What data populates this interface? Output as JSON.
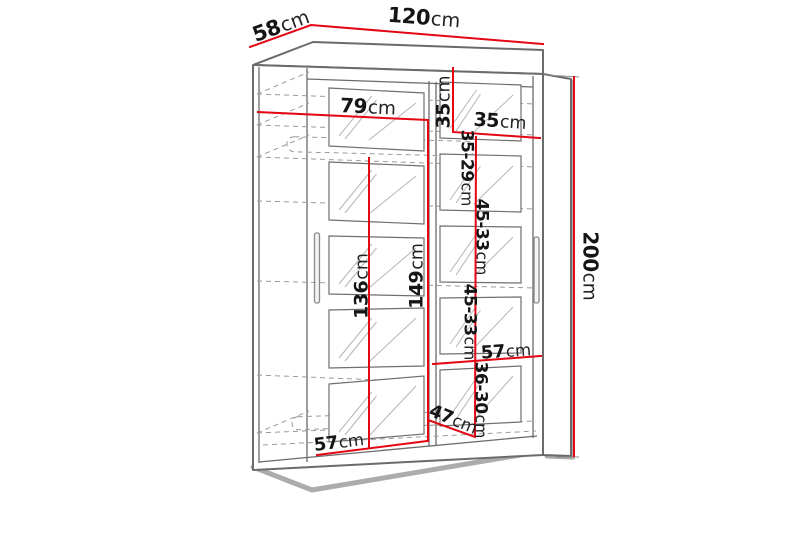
{
  "figure": {
    "type": "furniture-dimension-diagram",
    "subject": "sliding-door wardrobe with mirror panels",
    "unit": "cm"
  },
  "colors": {
    "dimension_line": "#e30613",
    "structure_line": "#6b6b6b",
    "dashed_line": "#9a9a9a",
    "text": "#151515",
    "background": "#ffffff"
  },
  "labels": {
    "depth_top": {
      "value": "58",
      "unit": "cm"
    },
    "width_top": {
      "value": "120",
      "unit": "cm"
    },
    "height_right": {
      "value": "200",
      "unit": "cm"
    },
    "hang_section_width": {
      "value": "79",
      "unit": "cm"
    },
    "top_shelf_height": {
      "value": "35",
      "unit": "cm"
    },
    "top_right_width": {
      "value": "35",
      "unit": "cm"
    },
    "shelf_gap_1": {
      "value": "35-29",
      "unit": "cm"
    },
    "shelf_gap_2": {
      "value": "45-33",
      "unit": "cm"
    },
    "left_interior_height": {
      "value": "136",
      "unit": "cm"
    },
    "right_interior_height": {
      "value": "149",
      "unit": "cm"
    },
    "shelf_gap_3": {
      "value": "45-33",
      "unit": "cm"
    },
    "right_shelf_width": {
      "value": "57",
      "unit": "cm"
    },
    "shelf_gap_4": {
      "value": "36-30",
      "unit": "cm"
    },
    "interior_depth": {
      "value": "47",
      "unit": "cm"
    },
    "bottom_left_width": {
      "value": "57",
      "unit": "cm"
    }
  }
}
